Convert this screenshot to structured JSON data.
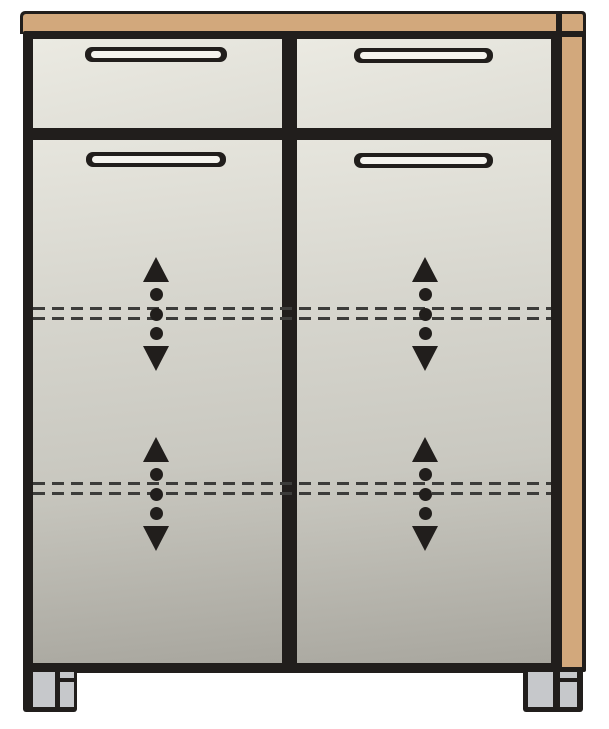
{
  "diagram": {
    "kind": "furniture-technical-illustration",
    "subject": "Cabinet with two top drawers, two doors, wooden top and right side panel, two adjustable shelf positions and two front feet",
    "visible_text": "",
    "colors": {
      "background": "#ffffff",
      "outline": "#211e1c",
      "wood": "#d2a87c",
      "drawer_front_light": "#ebeae2",
      "drawer_front_dark": "#deddd5",
      "door_front_top": "#e6e5dd",
      "door_front_bottom": "#a8a69e",
      "handle_slot": "#f4f3ee",
      "foot": "#c6c8cb",
      "dash": "#3c3c3a"
    },
    "structure": {
      "drawers": 2,
      "doors": 2,
      "handles": 4,
      "feet": 2,
      "adjustable_shelf_positions": 2,
      "shelf_adjust_indicators": 4
    },
    "shelf_line_pairs_y": [
      307,
      482
    ],
    "indicators": [
      {
        "door": "left",
        "shelf": "upper",
        "x": 142,
        "y": 257
      },
      {
        "door": "right",
        "shelf": "upper",
        "x": 411,
        "y": 257
      },
      {
        "door": "left",
        "shelf": "lower",
        "x": 142,
        "y": 437
      },
      {
        "door": "right",
        "shelf": "lower",
        "x": 411,
        "y": 437
      }
    ]
  }
}
